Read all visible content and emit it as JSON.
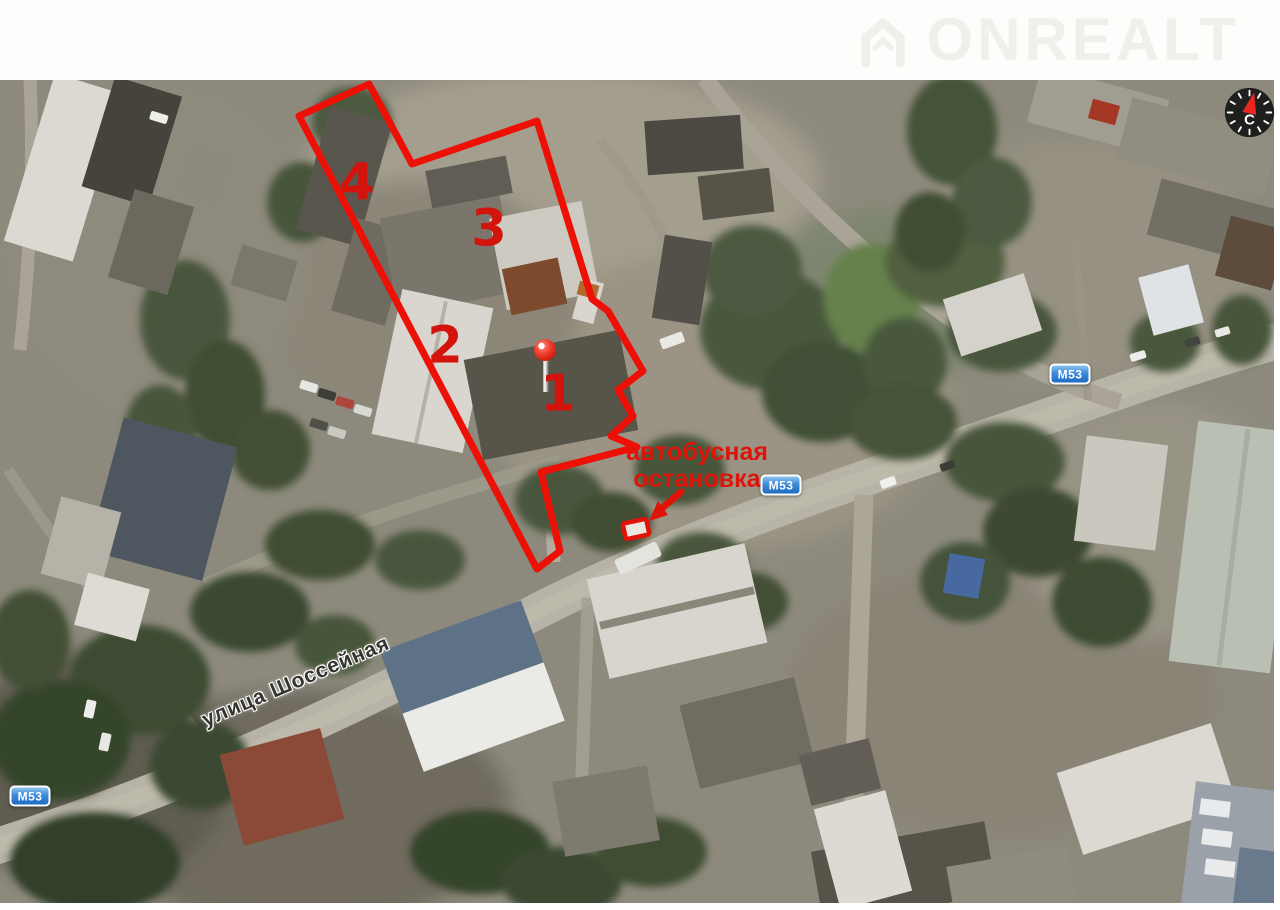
{
  "watermark": {
    "brand": "ONREALT"
  },
  "compass": {
    "north_letter": "С"
  },
  "map": {
    "street_label": "улица Шоссейная",
    "route_badges": [
      {
        "label": "М53"
      },
      {
        "label": "М53"
      },
      {
        "label": "М53"
      }
    ]
  },
  "plot": {
    "labels": [
      {
        "text": "1"
      },
      {
        "text": "2"
      },
      {
        "text": "3"
      },
      {
        "text": "4"
      }
    ]
  },
  "bus_stop": {
    "line1": "автобусная",
    "line2": "остановка"
  },
  "colors": {
    "annotation_red": "#ed1006",
    "plot_number_red": "#d2140c",
    "badge_blue": "#2f7fd0",
    "watermark_gray": "#f0efec"
  }
}
